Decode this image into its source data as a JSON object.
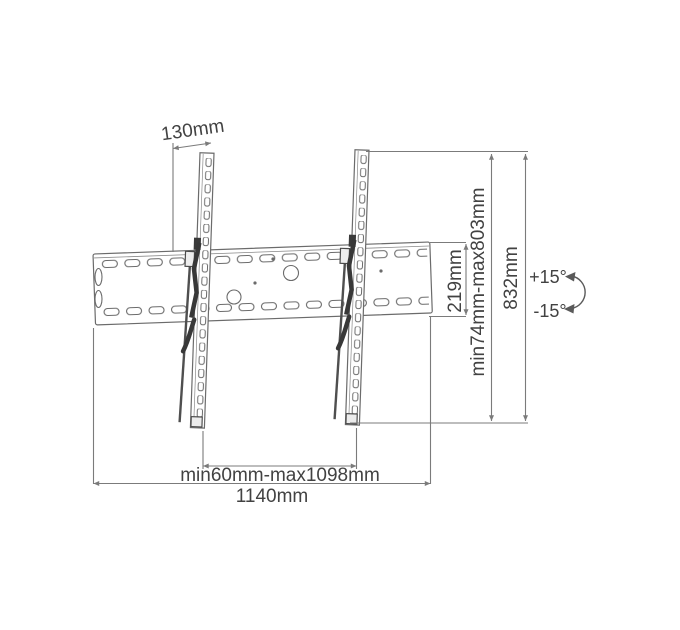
{
  "diagram": {
    "type": "tv-wall-mount-dimension-drawing",
    "labels": {
      "bracket_top_offset": "130mm",
      "wall_plate_height": "219mm",
      "vertical_hole_range": "min74mm-max803mm",
      "arm_total_height": "832mm",
      "tilt_up": "+15°",
      "tilt_down": "-15°",
      "arm_spacing_range": "min60mm-max1098mm",
      "wall_plate_width": "1140mm"
    },
    "colors": {
      "background": "#ffffff",
      "drawing_line": "#6b6b6b",
      "dimension_line": "#7b7b7b",
      "label_text": "#424242",
      "hardware_dark": "#3a3a3a"
    }
  }
}
